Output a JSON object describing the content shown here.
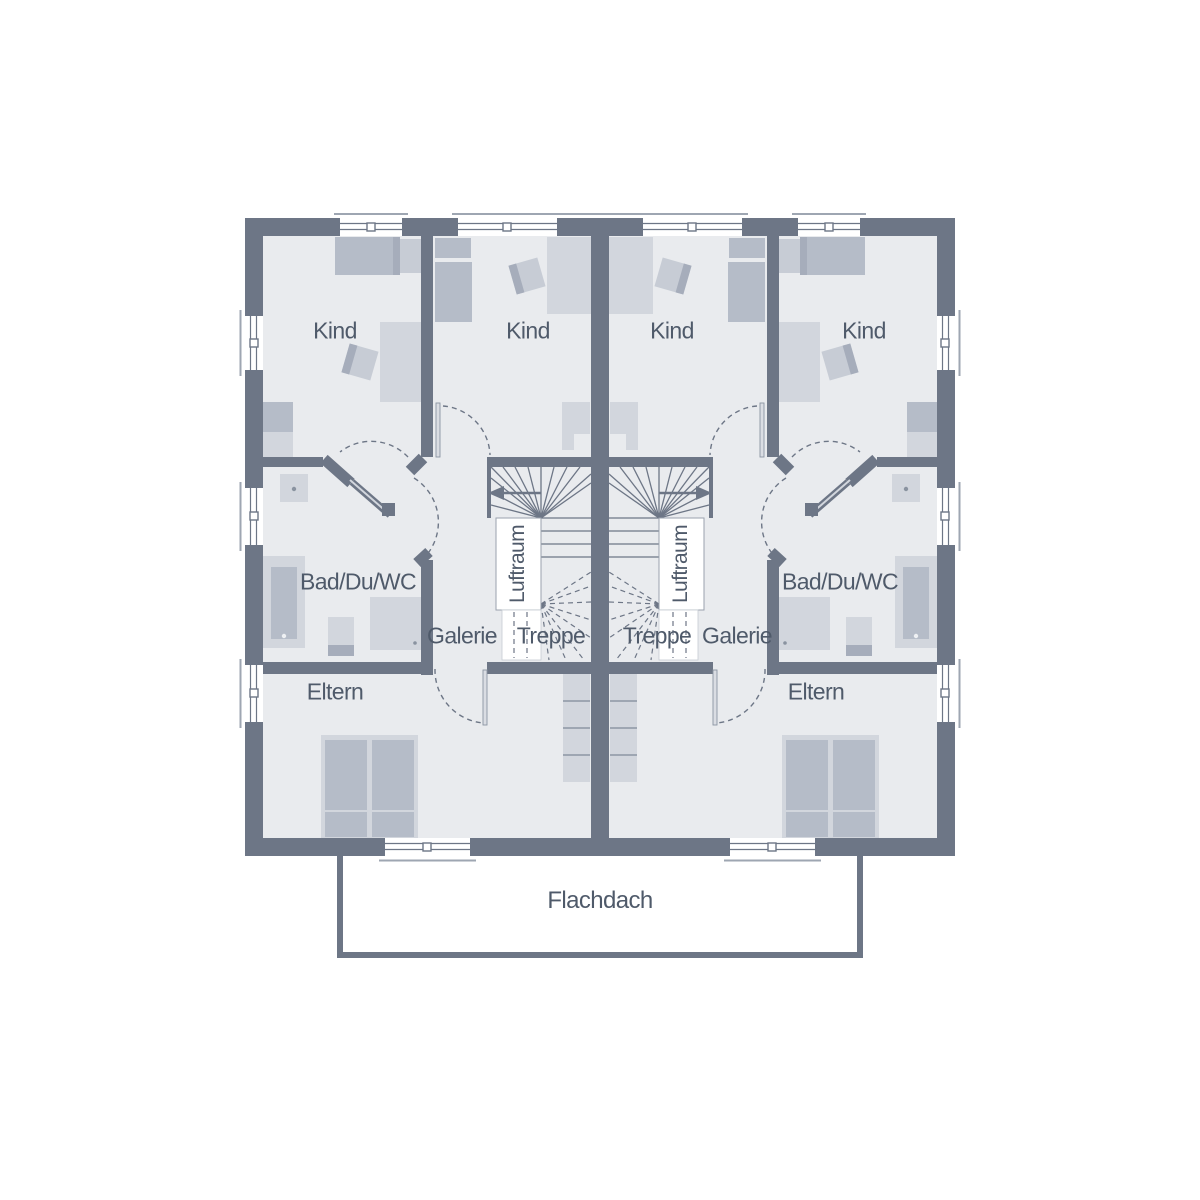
{
  "floor_plan": {
    "type": "residential-floor-plan",
    "description": "Upper floor plan of a mirrored semi-detached house (two units) with central stairs",
    "colors": {
      "wall": "#6d7686",
      "floor": "#e9ebee",
      "furn-light": "#d2d6dd",
      "furn-mid": "#b5bcc8",
      "furn-dark": "#a6adbb",
      "furn-soft": "#c7ccd5",
      "line": "#6d7686",
      "sill": "#9ea6b2",
      "text": "#4f5a6a",
      "white": "#ffffff"
    },
    "labels": [
      {
        "id": "kind-left-outer",
        "text": "Kind"
      },
      {
        "id": "kind-left-inner",
        "text": "Kind"
      },
      {
        "id": "kind-right-inner",
        "text": "Kind"
      },
      {
        "id": "kind-right-outer",
        "text": "Kind"
      },
      {
        "id": "bad-left",
        "text": "Bad/Du/WC"
      },
      {
        "id": "bad-right",
        "text": "Bad/Du/WC"
      },
      {
        "id": "galerie-left",
        "text": "Galerie"
      },
      {
        "id": "galerie-right",
        "text": "Galerie"
      },
      {
        "id": "treppe-left",
        "text": "Treppe"
      },
      {
        "id": "treppe-right",
        "text": "Treppe"
      },
      {
        "id": "luftraum-left",
        "text": "Luftraum"
      },
      {
        "id": "luftraum-right",
        "text": "Luftraum"
      },
      {
        "id": "eltern-left",
        "text": "Eltern"
      },
      {
        "id": "eltern-right",
        "text": "Eltern"
      },
      {
        "id": "flachdach",
        "text": "Flachdach"
      }
    ]
  }
}
